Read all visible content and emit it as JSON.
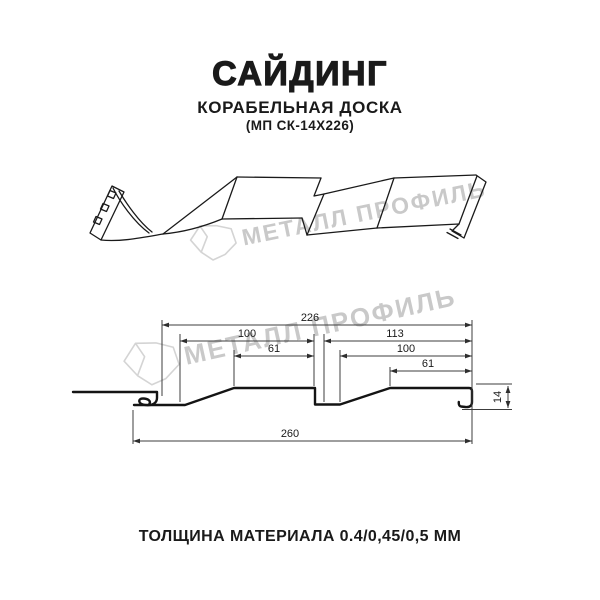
{
  "header": {
    "title": "САЙДИНГ",
    "subtitle": "КОРАБЕЛЬНАЯ ДОСКА",
    "model_code": "(МП СК-14Х226)"
  },
  "watermark": {
    "brand": "МЕТАЛЛ ПРОФИЛЬ"
  },
  "diagram": {
    "type": "technical-profile-drawing",
    "views": [
      "3d-perspective-view",
      "cross-section-with-dimensions"
    ],
    "dims": {
      "overall": "260",
      "working_width": "226",
      "left_pan": "100",
      "left_flat": "61",
      "right_span": "113",
      "right_pan": "100",
      "right_flat": "61",
      "height": "14"
    },
    "dimensions_mm": {
      "overall_width": 260,
      "working_width": 226,
      "board1_width": 100,
      "board1_flat": 61,
      "board2_span": 113,
      "board2_width": 100,
      "board2_flat": 61,
      "profile_height": 14
    }
  },
  "footer": {
    "thickness_note": "ТОЛЩИНА МАТЕРИАЛА 0.4/0,45/0,5 ММ"
  }
}
